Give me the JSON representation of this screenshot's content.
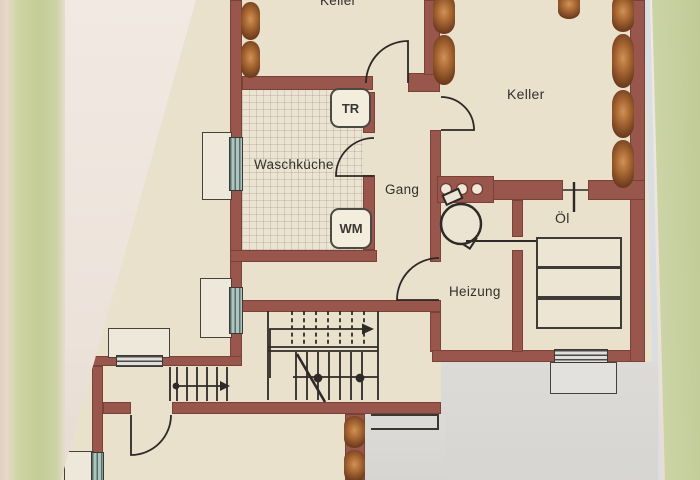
{
  "labels": {
    "keller_top": "Keller",
    "keller_right": "Keller",
    "waschkueche": "Waschküche",
    "gang": "Gang",
    "heizung": "Heizung",
    "oel": "Öl"
  },
  "appliances": {
    "dryer": "TR",
    "washer": "WM"
  },
  "colors": {
    "wall": "#98564d",
    "walledge": "#7a4138",
    "paper": "#eae1cd",
    "shade": "#d9d8d3",
    "line": "#2d2a27",
    "greenwall": "#c9d09f",
    "photowall": "#f1e9e2",
    "paperedge": "#d9dee3",
    "windowteal": "#aec4bd"
  }
}
